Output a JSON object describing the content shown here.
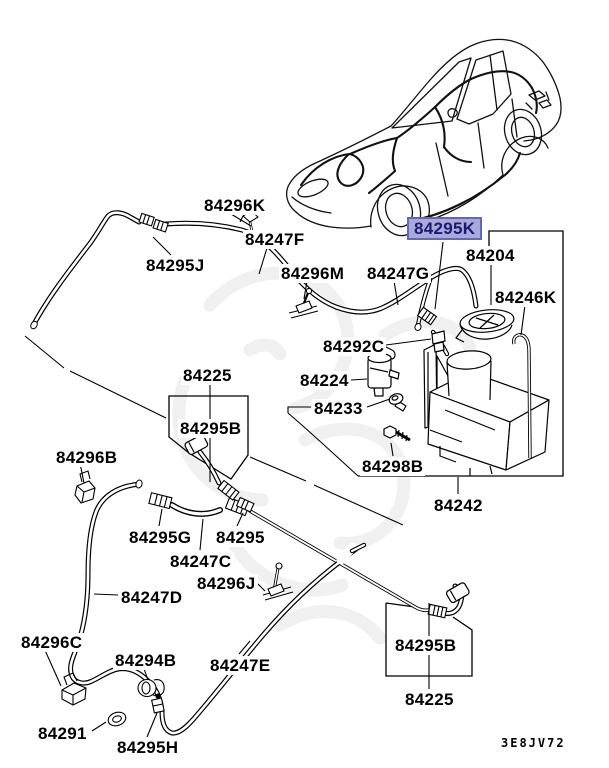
{
  "diagram": {
    "description": "Windshield washer parts diagram",
    "code_label": {
      "text": "3E8JV72"
    },
    "highlighted_part": "84295K",
    "colors": {
      "background": "#ffffff",
      "line": "#000000",
      "watermark": "#e4e4e4",
      "highlight_bg": "#a9a9dc",
      "highlight_border": "#6666b3",
      "highlight_text": "#1a1a70"
    },
    "labels": [
      {
        "text": "84296K"
      },
      {
        "text": "84247F"
      },
      {
        "text": "84295J"
      },
      {
        "text": "84296M"
      },
      {
        "text": "84247G"
      },
      {
        "text": "84295K"
      },
      {
        "text": "84204"
      },
      {
        "text": "84246K"
      },
      {
        "text": "84292C"
      },
      {
        "text": "84224"
      },
      {
        "text": "84233"
      },
      {
        "text": "84298B"
      },
      {
        "text": "84242"
      },
      {
        "text": "84225"
      },
      {
        "text": "84295B"
      },
      {
        "text": "84296B"
      },
      {
        "text": "84295G"
      },
      {
        "text": "84295"
      },
      {
        "text": "84247C"
      },
      {
        "text": "84296J"
      },
      {
        "text": "84247D"
      },
      {
        "text": "84296C"
      },
      {
        "text": "84294B"
      },
      {
        "text": "84247E"
      },
      {
        "text": "84295B"
      },
      {
        "text": "84291"
      },
      {
        "text": "84295H"
      },
      {
        "text": "84225"
      }
    ]
  }
}
